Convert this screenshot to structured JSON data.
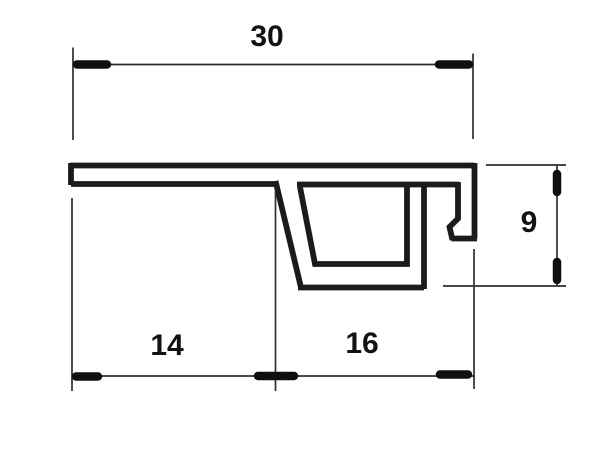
{
  "drawing": {
    "description": "Technical cross-section drawing of an extruded edge profile with dimension lines",
    "background_color": "#ffffff",
    "line_color": "#1b1b1b",
    "dimensions": {
      "top_width": "30",
      "bottom_left": "14",
      "bottom_right": "16",
      "right_height": "9"
    }
  }
}
